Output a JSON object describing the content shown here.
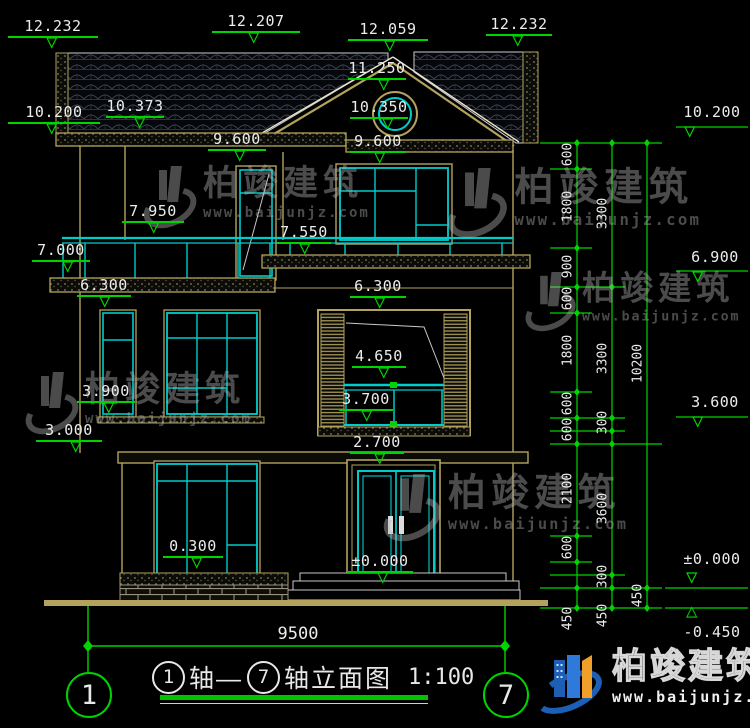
{
  "watermark": {
    "brand": "柏竣建筑",
    "url": "www.baijunjz.com"
  },
  "logo": {
    "brand": "柏竣建筑",
    "url": "www.baijunjz.com"
  },
  "title_block": {
    "axis_from": "1",
    "joiner": "轴—",
    "axis_to": "7",
    "name": "轴立面图",
    "scale": "1:100"
  },
  "axis_bubbles": {
    "left": "1",
    "right": "7"
  },
  "dims": {
    "overall_width": "9500",
    "col1": [
      "600",
      "1800",
      "900",
      "600",
      "1800",
      "600",
      "600",
      "2100",
      "600",
      "450"
    ],
    "col2": [
      "3300",
      "3300",
      "300",
      "3600",
      "300",
      "450"
    ],
    "col3": [
      "10200",
      "450"
    ]
  },
  "elevations": {
    "roof_left_parapet": "12.232",
    "roof_left_top": "12.207",
    "ridge": "12.059",
    "roof_right_parapet": "12.232",
    "gable_mid": "11.250",
    "round_window": "10.350",
    "eave_left": "10.200",
    "eave_soffit": "10.373",
    "eave_right": "10.200",
    "win3_top_left": "9.600",
    "win3_top_center": "9.600",
    "balcony_rail_left": "7.950",
    "balcony_rail_center": "7.550",
    "balcony_slab_left": "7.000",
    "floor3_right": "6.900",
    "win2_top_left": "6.300",
    "win2_top_center": "6.300",
    "recess_rail_top": "4.650",
    "recess_rail_bottom": "3.700",
    "win2_sill_left": "3.900",
    "floor2_slab_left": "3.000",
    "floor2_right": "3.600",
    "door_top": "2.700",
    "win1_sill": "0.300",
    "ground_door": "±0.000",
    "ground_right": "±0.000",
    "site_level": "-0.450"
  }
}
